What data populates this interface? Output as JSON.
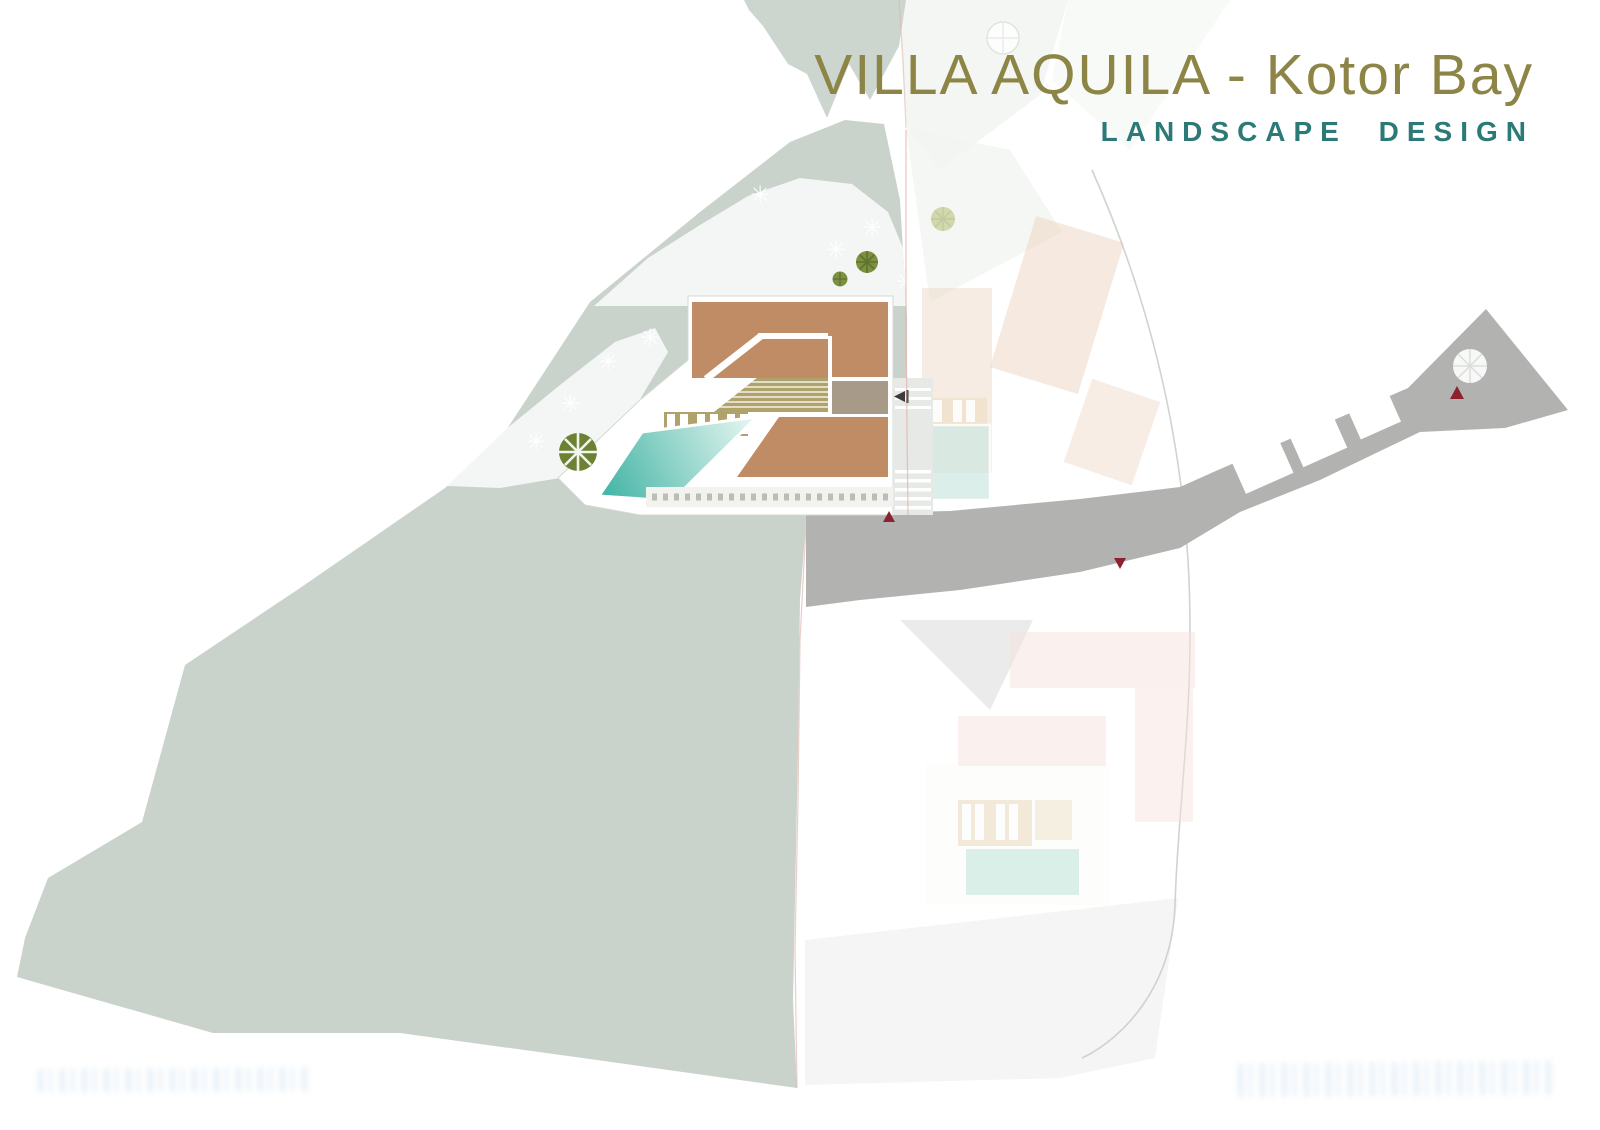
{
  "header": {
    "project_title": "VILLA AQUILA - Kotor Bay",
    "subtitle": "LANDSCAPE DESIGN"
  },
  "watermarks": {
    "bottom_left": "illegible faint blue text",
    "bottom_right": "illegible faint blue text"
  },
  "palette": {
    "title_gold": "#8d8546",
    "subtitle_teal": "#2b7a78",
    "sage": "#c9d3cb",
    "sage_top": "#ccd6ce",
    "rock_white": "#f6f8f5",
    "wash_light": "#edefec",
    "road_gray": "#b2b3b1",
    "road_triangle": "#eaebea",
    "roof_brown": "#c08c65",
    "deck_khaki": "#b0a26b",
    "room_graybrown": "#a89a88",
    "pool_dark": "#3fb3a3",
    "pool_light": "#eaf7f3",
    "neighbor_roof": "#eed4c0",
    "neighbor_pool": "#cfe9e2",
    "faint_pink_roof": "#f6e3de",
    "faint_pool": "#d8eee7",
    "lounger_tan": "#e9d9bb",
    "tree_olive": "#7c9040",
    "tree_olive_dark": "#6d8132",
    "tree_spoke": "#5f732e",
    "tree_faded": "#ccd3a0",
    "marker_red": "#8e2130",
    "boundary_pink": "#dfaca4",
    "boundary_gray": "#c6cdc6",
    "driveway_gray": "#e7e9e6",
    "watermark_blue": "#cfe2f2"
  },
  "icons": {
    "tree": "tree-canopy-icon",
    "shrub": "white-shrub-star-icon",
    "direction_marker": "red-triangle-marker-icon",
    "entrance_arrow": "black-arrow-icon"
  }
}
